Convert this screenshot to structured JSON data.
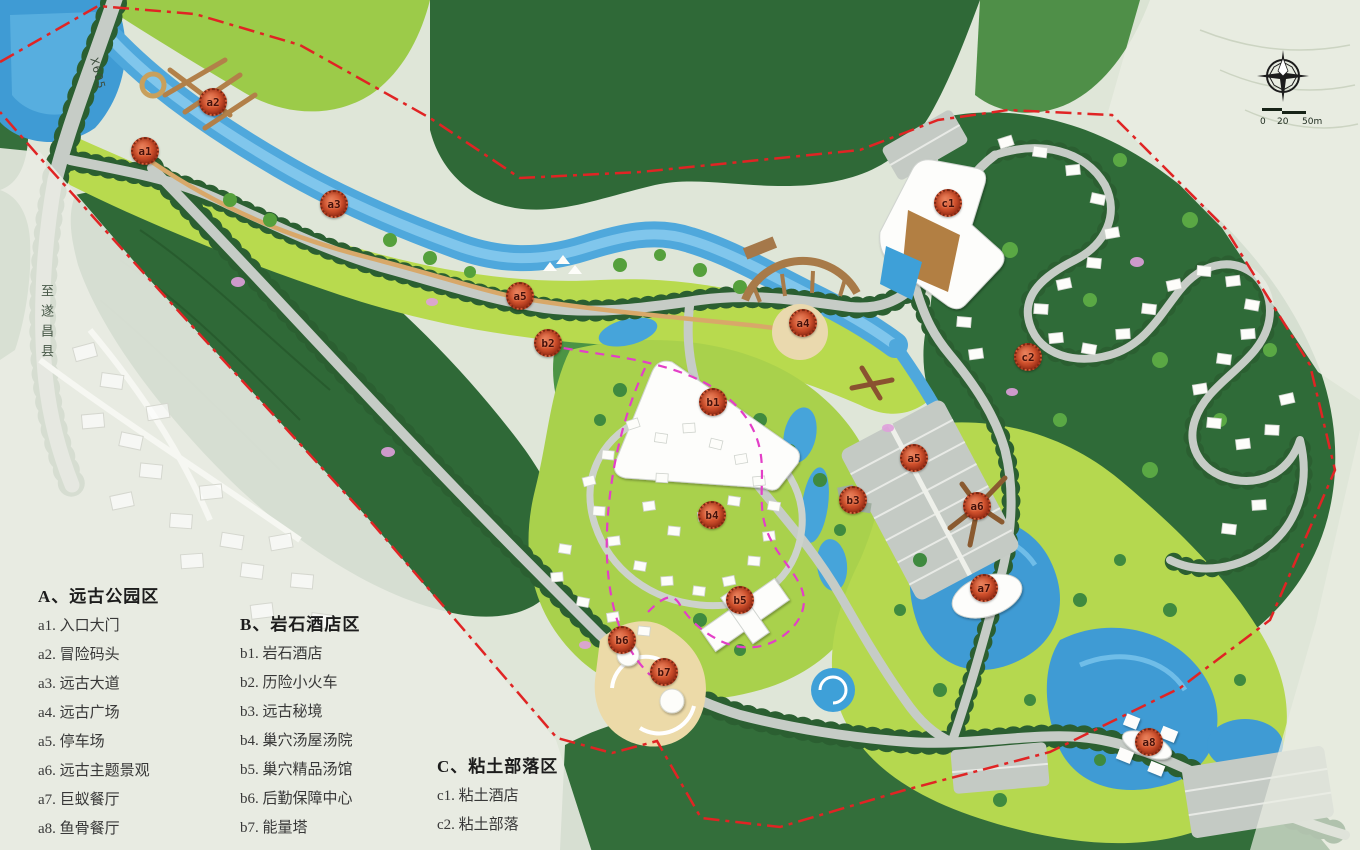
{
  "legends": {
    "a": {
      "title": "A、远古公园区",
      "items": [
        "a1. 入口大门",
        "a2. 冒险码头",
        "a3. 远古大道",
        "a4. 远古广场",
        "a5. 停车场",
        "a6. 远古主题景观",
        "a7. 巨蚁餐厅",
        "a8. 鱼骨餐厅"
      ]
    },
    "b": {
      "title": "B、岩石酒店区",
      "items": [
        "b1. 岩石酒店",
        "b2. 历险小火车",
        "b3. 远古秘境",
        "b4. 巢穴汤屋汤院",
        "b5. 巢穴精品汤馆",
        "b6. 后勤保障中心",
        "b7. 能量塔"
      ]
    },
    "c": {
      "title": "C、粘土部落区",
      "items": [
        "c1. 粘土酒店",
        "c2. 粘土部落"
      ]
    }
  },
  "markers": [
    {
      "label": "a1"
    },
    {
      "label": "a2"
    },
    {
      "label": "a3"
    },
    {
      "label": "a5"
    },
    {
      "label": "b2"
    },
    {
      "label": "a4"
    },
    {
      "label": "c1"
    },
    {
      "label": "c2"
    },
    {
      "label": "b1"
    },
    {
      "label": "a5"
    },
    {
      "label": "b3"
    },
    {
      "label": "a6"
    },
    {
      "label": "b4"
    },
    {
      "label": "a7"
    },
    {
      "label": "b5"
    },
    {
      "label": "b6"
    },
    {
      "label": "b7"
    },
    {
      "label": "a8"
    }
  ],
  "road_labels": {
    "x605": "X605",
    "to_county": "至遂昌县"
  },
  "scale_bar": {
    "ticks": [
      "0",
      "20",
      "50m"
    ]
  },
  "colors": {
    "boundary_red": "#e02424",
    "train_magenta": "#e33fc7",
    "water_blue": "#4fa8dc",
    "forest_dark": "#2f6937",
    "meadow": "#b8da4e",
    "marker_orange": "#c04326"
  }
}
